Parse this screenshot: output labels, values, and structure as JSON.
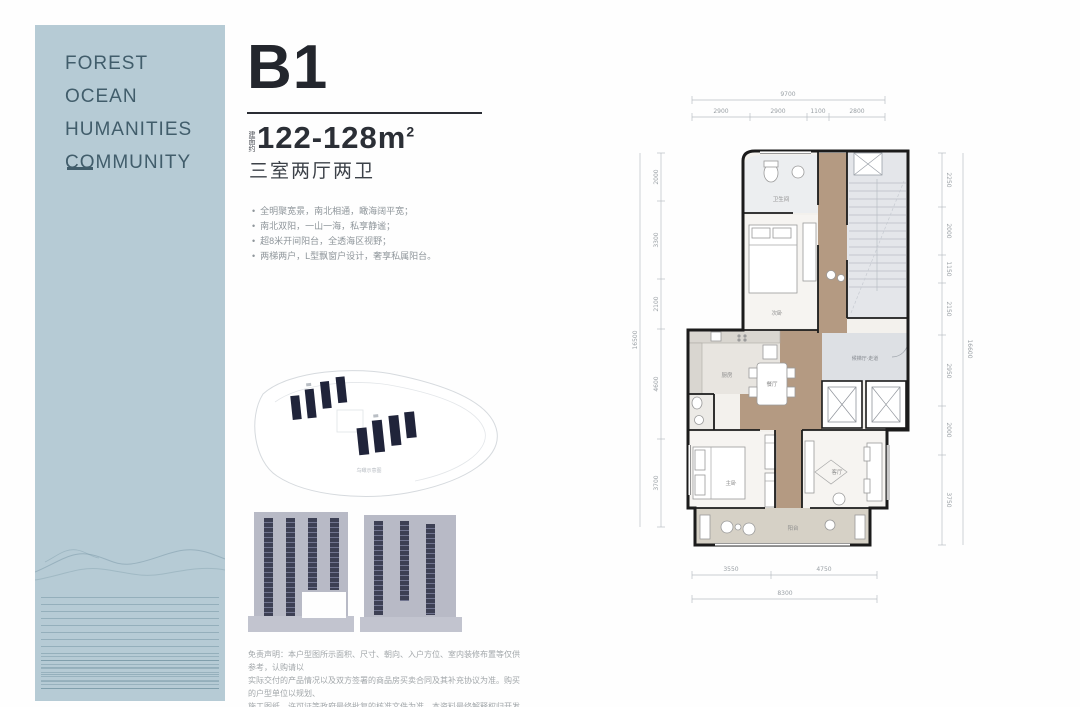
{
  "sidebar": {
    "line1": "FOREST OCEAN",
    "line2": "HUMANITIES",
    "line3": "COMMUNITY",
    "bg_color": "#b6cbd5",
    "text_color": "#415d6b"
  },
  "unit": {
    "name": "B1",
    "area_prefix": "建面约",
    "area": "122-128m",
    "area_sup": "2",
    "layout": "三室两厅两卫",
    "features": [
      "全明聚宽景，南北相通，瞰海阔平宽；",
      "南北双阳，一山一海，私享静谧；",
      "超8米开间阳台，全透海区视野；",
      "两梯两户，L型飘窗户设计，奢享私属阳台。"
    ]
  },
  "siteplan": {
    "caption": "鸟瞰示意图"
  },
  "disclaimer": {
    "line1": "免责声明：本户型图所示面积、尺寸、朝向、入户方位、室内装修布置等仅供参考，认购请以",
    "line2": "实际交付的产品情况以及双方签署的商品房买卖合同及其补充协议为准。购买的户型单位以规划、",
    "line3": "施工图纸、许可证等政府最终批复的核准文件为准，本资料最终解释权归开发商所有。"
  },
  "floorplan": {
    "rooms": {
      "bath": "卫生间",
      "bedroom2": "次卧",
      "kitchen": "厨房",
      "dining": "餐厅",
      "hall": "候梯厅·走道",
      "master": "主卧",
      "living": "客厅",
      "balcony": "阳台"
    },
    "dims_top": {
      "total": "9700",
      "segments": [
        "2900",
        "2900",
        "1100",
        "2800"
      ]
    },
    "dims_bottom": {
      "total": "8300",
      "segments": [
        "3550",
        "4750"
      ]
    },
    "dims_left": {
      "total": "16500",
      "segments": [
        "2000",
        "3300",
        "2100",
        "4600",
        "3700"
      ]
    },
    "dims_right": {
      "total": "16600",
      "segments": [
        "2250",
        "2000",
        "1150",
        "2150",
        "2950",
        "2000",
        "3750"
      ]
    }
  }
}
